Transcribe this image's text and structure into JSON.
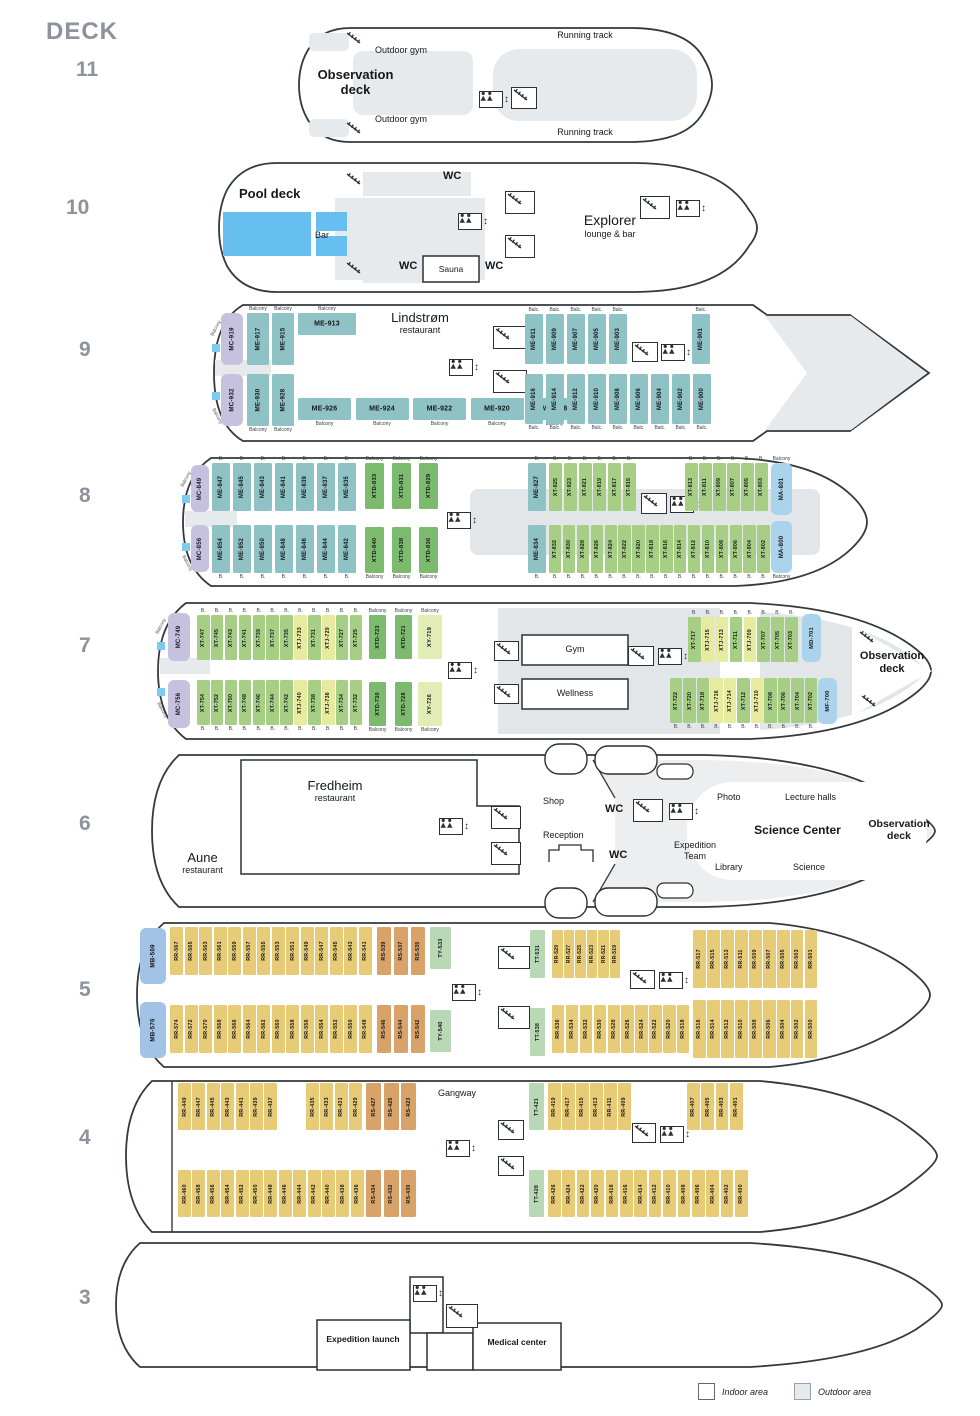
{
  "page": {
    "deck_label": "DECK",
    "deck_numbers": [
      "11",
      "10",
      "9",
      "8",
      "7",
      "6",
      "5",
      "4",
      "3"
    ]
  },
  "legend": {
    "indoor": "Indoor area",
    "outdoor": "Outdoor area"
  },
  "colors": {
    "MC": "#c7c1e0",
    "ME": "#8fc2c4",
    "XT": "#a6cf85",
    "XTJ": "#e7eb9f",
    "XTD": "#7cba6d",
    "XY": "#e2edb5",
    "MA": "#abd3ec",
    "MB": "#a3c3e6",
    "MD": "#abd3ec",
    "MF": "#abd3ec",
    "RR": "#e7cb76",
    "RS": "#d8a268",
    "TY": "#b9d9b6",
    "TT": "#b9d9b6",
    "pool": "#66bfee",
    "outdoor": "#e7eaec",
    "hull_stroke": "#35393d"
  },
  "decks": {
    "d11": {
      "labels": {
        "running_track_top": "Running track",
        "outdoor_gym_top": "Outdoor gym",
        "observation_deck": "Observation deck",
        "outdoor_gym_bottom": "Outdoor gym",
        "running_track_bottom": "Running track"
      }
    },
    "d10": {
      "labels": {
        "pool_deck": "Pool deck",
        "bar": "Bar",
        "wc_top": "WC",
        "explorer_title": "Explorer",
        "explorer_sub": "lounge & bar",
        "wc_bottom_left": "WC",
        "sauna": "Sauna",
        "wc_bottom_right": "WC"
      }
    },
    "d9": {
      "labels": {
        "restaurant_title": "Lindstrøm",
        "restaurant_sub": "restaurant",
        "balcony_stern_top": "Balcony",
        "balcony_stern_bottom": "Balcony"
      },
      "rows": {
        "mc_t": {
          "cabins": [
            "MC-919"
          ]
        },
        "me_t": {
          "cabins": [
            "ME-917",
            "ME-915"
          ],
          "balcony": "Balcony",
          "side": "top"
        },
        "me913": {
          "cabins": [
            "ME-913"
          ],
          "balcony": "Balcony",
          "side": "top",
          "horiz": true
        },
        "mc_b": {
          "cabins": [
            "MC-932"
          ]
        },
        "me_b": {
          "cabins": [
            "ME-930",
            "ME-928"
          ],
          "balcony": "Balcony",
          "side": "bottom"
        },
        "meh_b": {
          "cabins": [
            "ME-926",
            "ME-924",
            "ME-922",
            "ME-920",
            "ME-918"
          ],
          "balcony": "Balcony",
          "side": "bottom",
          "horiz": true
        },
        "me_tr": {
          "cabins": [
            "ME-911",
            "ME-909",
            "ME-907",
            "ME-905",
            "ME-903"
          ],
          "balcony": "Balc.",
          "side": "top"
        },
        "me901": {
          "cabins": [
            "ME-901"
          ],
          "balcony": "Balc.",
          "side": "top"
        },
        "me_br": {
          "cabins": [
            "ME-916",
            "ME-914",
            "ME-912",
            "ME-910",
            "ME-908",
            "ME-906",
            "ME-904",
            "ME-902",
            "ME-900"
          ],
          "balcony": "Balc.",
          "side": "bottom"
        }
      }
    },
    "d8": {
      "labels": {
        "balcony_stern_top": "Balcony",
        "balcony_stern_bottom": "Balcony"
      },
      "rows": {
        "mc_t": {
          "cabins": [
            "MC-849"
          ]
        },
        "me_t": {
          "cabins": [
            "ME-847",
            "ME-845",
            "ME-843",
            "ME-841",
            "ME-839",
            "ME-837",
            "ME-835"
          ],
          "balcony": "B.",
          "side": "top"
        },
        "xtd_t": {
          "cabins": [
            "XTD-833",
            "XTD-831",
            "XTD-829"
          ],
          "balcony": "Balcony",
          "side": "top"
        },
        "mc_b": {
          "cabins": [
            "MC-856"
          ]
        },
        "me_b": {
          "cabins": [
            "ME-854",
            "ME-852",
            "ME-850",
            "ME-848",
            "ME-846",
            "ME-844",
            "ME-842"
          ],
          "balcony": "B.",
          "side": "bottom"
        },
        "xtd_b": {
          "cabins": [
            "XTD-840",
            "XTD-838",
            "XTD-836"
          ],
          "balcony": "Balcony",
          "side": "bottom"
        },
        "me827": {
          "cabins": [
            "ME-827"
          ],
          "balcony": "B.",
          "side": "top"
        },
        "xt_t": {
          "cabins": [
            "XT-825",
            "XT-823",
            "XT-821",
            "XT-819",
            "XT-817",
            "XT-815"
          ],
          "balcony": "B.",
          "side": "top"
        },
        "xt_t2": {
          "cabins": [
            "XT-813",
            "XT-811",
            "XT-809",
            "XT-807",
            "XT-805",
            "XT-803"
          ],
          "balcony": "B.",
          "side": "top"
        },
        "ma801": {
          "cabins": [
            "MA-801"
          ],
          "balcony": "Balcony",
          "side": "top"
        },
        "me834": {
          "cabins": [
            "ME-834"
          ],
          "balcony": "B.",
          "side": "bottom"
        },
        "xt_b": {
          "cabins": [
            "XT-832",
            "XT-830",
            "XT-828",
            "XT-826",
            "XT-824",
            "XT-822",
            "XT-820",
            "XT-818",
            "XT-816",
            "XT-814",
            "XT-812",
            "XT-810",
            "XT-808",
            "XT-806",
            "XT-804",
            "XT-802"
          ],
          "balcony": "B.",
          "side": "bottom"
        },
        "ma800": {
          "cabins": [
            "MA-800"
          ],
          "balcony": "Balcony",
          "side": "bottom"
        }
      }
    },
    "d7": {
      "labels": {
        "gym": "Gym",
        "wellness": "Wellness",
        "observation_deck": "Observation deck",
        "balcony_stern_top": "Balcony",
        "balcony_stern_bottom": "Balcony"
      },
      "rows": {
        "mc_t": {
          "cabins": [
            "MC-749"
          ]
        },
        "xt_t": {
          "cabins": [
            "XT-747",
            "XT-745",
            "XT-743",
            "XT-741",
            "XT-739",
            "XT-737",
            "XT-735",
            "XTJ-733",
            "XT-731",
            "XTJ-729",
            "XT-727",
            "XT-725"
          ],
          "balcony": "B.",
          "side": "top"
        },
        "xtd_t": {
          "cabins": [
            "XTD-723",
            "XTD-721"
          ],
          "balcony": "Balcony",
          "side": "top"
        },
        "xy719": {
          "cabins": [
            "XY-719"
          ],
          "balcony": "Balcony",
          "side": "top"
        },
        "mc_b": {
          "cabins": [
            "MC-756"
          ]
        },
        "xt_b": {
          "cabins": [
            "XT-754",
            "XT-752",
            "XT-750",
            "XT-748",
            "XT-746",
            "XT-744",
            "XT-742",
            "XTJ-740",
            "XT-738",
            "XTJ-736",
            "XT-734",
            "XT-732"
          ],
          "balcony": "B.",
          "side": "bottom"
        },
        "xtd_b": {
          "cabins": [
            "XTD-730",
            "XTD-728"
          ],
          "balcony": "Balcony",
          "side": "bottom"
        },
        "xy726": {
          "cabins": [
            "XY-726"
          ],
          "balcony": "Balcony",
          "side": "bottom"
        },
        "xt_tr": {
          "cabins": [
            "XT-717",
            "XTJ-715",
            "XTJ-713",
            "XT-711",
            "XTJ-709",
            "XT-707",
            "XT-705",
            "XT-703"
          ],
          "balcony": "B.",
          "side": "top"
        },
        "md701": {
          "cabins": [
            "MD-701"
          ]
        },
        "xt_br": {
          "cabins": [
            "XT-722",
            "XT-720",
            "XT-718",
            "XTJ-716",
            "XTJ-714",
            "XT-712",
            "XTJ-710",
            "XT-708",
            "XT-706",
            "XT-704",
            "XT-702"
          ],
          "balcony": "B.",
          "side": "bottom"
        },
        "mf700": {
          "cabins": [
            "MF-700"
          ]
        }
      }
    },
    "d6": {
      "labels": {
        "fredheim_title": "Fredheim",
        "fredheim_sub": "restaurant",
        "aune_title": "Aune",
        "aune_sub": "restaurant",
        "shop": "Shop",
        "wc_1": "WC",
        "reception": "Reception",
        "wc_2": "WC",
        "expedition_team": "Expedition Team",
        "photo": "Photo",
        "lecture_halls": "Lecture halls",
        "science_center": "Science Center",
        "library": "Library",
        "science": "Science",
        "observation_deck": "Observation deck"
      }
    },
    "d5": {
      "rows": {
        "mb569": {
          "cabins": [
            "MB-569"
          ]
        },
        "rr_t": {
          "cabins": [
            "RR-567",
            "RR-565",
            "RR-563",
            "RR-561",
            "RR-559",
            "RR-557",
            "RR-555",
            "RR-553",
            "RR-551",
            "RR-549",
            "RR-547",
            "RR-545",
            "RR-543",
            "RR-541"
          ]
        },
        "rs_t": {
          "cabins": [
            "RS-539",
            "RS-537",
            "RS-535"
          ]
        },
        "ty533": {
          "cabins": [
            "TY-533"
          ]
        },
        "mb576": {
          "cabins": [
            "MB-576"
          ]
        },
        "rr_b": {
          "cabins": [
            "RR-574",
            "RR-572",
            "RR-570",
            "RR-568",
            "RR-566",
            "RR-564",
            "RR-562",
            "RR-560",
            "RR-558",
            "RR-556",
            "RR-554",
            "RR-552",
            "RR-550",
            "RR-548"
          ]
        },
        "rs_b": {
          "cabins": [
            "RS-546",
            "RS-544",
            "RS-542"
          ]
        },
        "ty540": {
          "cabins": [
            "TY-540"
          ]
        },
        "tt531": {
          "cabins": [
            "TT-531"
          ]
        },
        "rr_tr1": {
          "cabins": [
            "RR-529",
            "RR-527",
            "RR-525",
            "RR-523",
            "RR-521",
            "RR-519"
          ]
        },
        "rr_tr2": {
          "cabins": [
            "RR-517",
            "RR-515",
            "RR-513",
            "RR-511",
            "RR-509",
            "RR-507",
            "RR-505",
            "RR-503",
            "RR-501"
          ]
        },
        "tt538": {
          "cabins": [
            "TT-538"
          ]
        },
        "rr_br1": {
          "cabins": [
            "RR-536",
            "RR-534",
            "RR-532",
            "RR-530",
            "RR-528",
            "RR-526",
            "RR-524",
            "RR-522",
            "RR-520",
            "RR-518"
          ]
        },
        "rr_br2": {
          "cabins": [
            "RR-516",
            "RR-514",
            "RR-512",
            "RR-510",
            "RR-508",
            "RR-506",
            "RR-504",
            "RR-502",
            "RR-500"
          ]
        }
      }
    },
    "d4": {
      "labels": {
        "gangway": "Gangway"
      },
      "rows": {
        "tl1": {
          "cabins": [
            "RR-449",
            "RR-447",
            "RR-445",
            "RR-443",
            "RR-441",
            "RR-439",
            "RR-437"
          ]
        },
        "tl2": {
          "cabins": [
            "RR-435",
            "RR-433",
            "RR-431",
            "RR-429"
          ]
        },
        "rs_t": {
          "cabins": [
            "RS-427",
            "RS-425",
            "RS-423"
          ]
        },
        "bl": {
          "cabins": [
            "RR-460",
            "RR-458",
            "RR-456",
            "RR-454",
            "RR-452",
            "RR-450",
            "RR-448",
            "RR-446",
            "RR-444",
            "RR-442",
            "RR-440",
            "RR-438",
            "RR-436"
          ]
        },
        "rs_b": {
          "cabins": [
            "RS-434",
            "RS-432",
            "RS-430"
          ]
        },
        "tt421": {
          "cabins": [
            "TT-421"
          ]
        },
        "tr1": {
          "cabins": [
            "RR-419",
            "RR-417",
            "RR-415",
            "RR-413",
            "RR-411",
            "RR-409"
          ]
        },
        "tr2": {
          "cabins": [
            "RR-407",
            "RR-405",
            "RR-403",
            "RR-401"
          ]
        },
        "tt428": {
          "cabins": [
            "TT-428"
          ]
        },
        "br": {
          "cabins": [
            "RR-426",
            "RR-424",
            "RR-422",
            "RR-420",
            "RR-418",
            "RR-416",
            "RR-414",
            "RR-412",
            "RR-410",
            "RR-408",
            "RR-406",
            "RR-404",
            "RR-402",
            "RR-400"
          ]
        }
      }
    },
    "d3": {
      "labels": {
        "expedition_launch": "Expedition launch",
        "medical_center": "Medical center"
      }
    }
  }
}
